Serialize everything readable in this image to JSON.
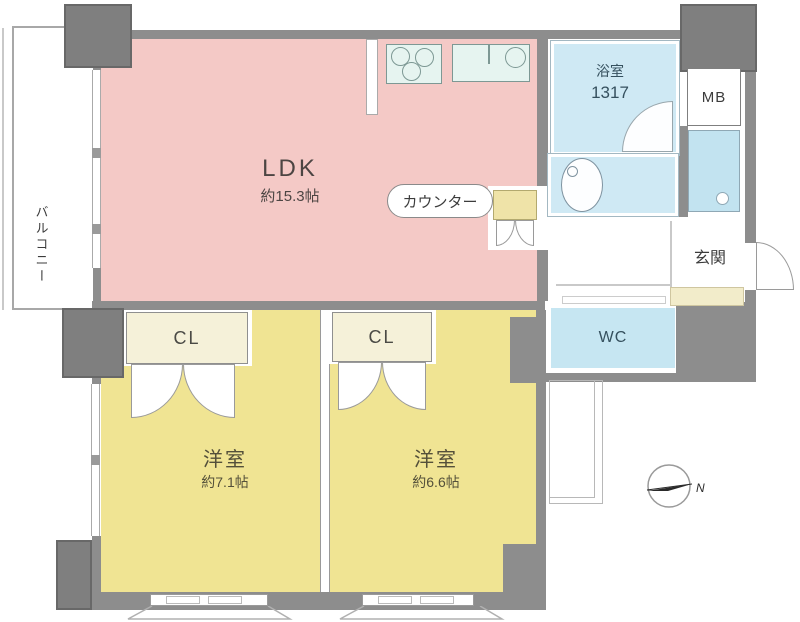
{
  "title": "apartment-floor-plan",
  "colors": {
    "wall": "#8d8d8d",
    "pillar": "#7f7f7f",
    "ldk": "#f4c9c6",
    "bedroom": "#f0e493",
    "bath": "#cfe9f4",
    "wc": "#c6e6f2",
    "washpan": "#c2e3f0",
    "appliance": "#e6f4f0",
    "closet": "#f5f1d9",
    "counter": "#efe3a8",
    "step": "#f2ecca"
  },
  "rooms": {
    "ldk": {
      "label": "LDK",
      "size": "約15.3帖"
    },
    "bedroom1": {
      "label": "洋室",
      "size": "約7.1帖"
    },
    "bedroom2": {
      "label": "洋室",
      "size": "約6.6帖"
    },
    "bathroom": {
      "label": "浴室",
      "size": "1317"
    },
    "wc": {
      "label": "WC"
    },
    "entrance": {
      "label": "玄関"
    },
    "balcony": {
      "label": "バルコニー"
    },
    "mb": {
      "label": "MB"
    },
    "closet1": {
      "label": "CL"
    },
    "closet2": {
      "label": "CL"
    },
    "counter": {
      "label": "カウンター"
    }
  },
  "compass": {
    "north_label": "N"
  }
}
